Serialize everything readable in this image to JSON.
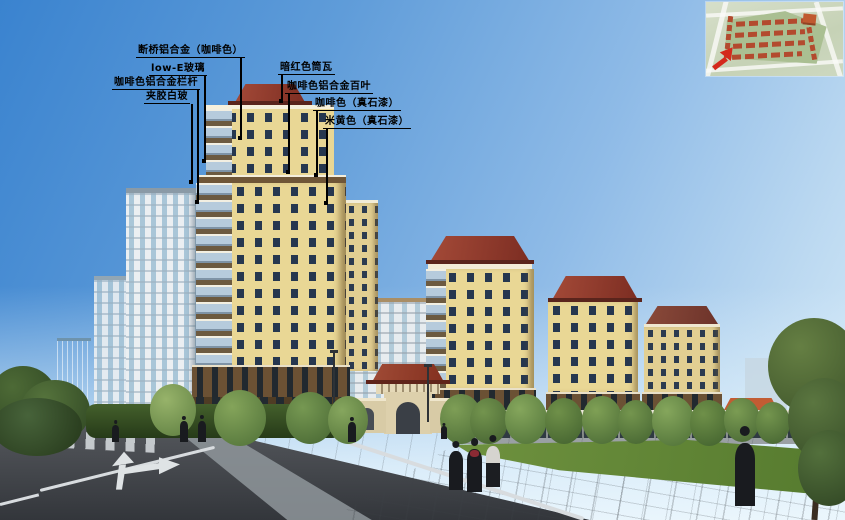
{
  "annotations": [
    {
      "id": "thermal-break-aluminum",
      "text": "断桥铝合金（咖啡色）"
    },
    {
      "id": "low-e-glass",
      "text": "low-E玻璃"
    },
    {
      "id": "coffee-aluminum-railing",
      "text": "咖啡色铝合金栏杆"
    },
    {
      "id": "laminated-white-glass",
      "text": "夹胶白玻"
    },
    {
      "id": "dark-red-barrel-tile",
      "text": "暗红色筒瓦"
    },
    {
      "id": "coffee-aluminum-louver",
      "text": "咖啡色铝合金百叶"
    },
    {
      "id": "coffee-stone-paint",
      "text": "咖啡色（真石漆）"
    },
    {
      "id": "beige-stone-paint",
      "text": "米黄色（真石漆）"
    }
  ],
  "icons": {
    "site_plan_arrow": "red-location-arrow"
  },
  "colors": {
    "sky_top": "#3a83cf",
    "sky_horizon": "#d6ebf9",
    "annotation_text": "#000000",
    "building_beige": "#e9d795",
    "building_window": "#26374f",
    "roof_dark_red": "#8b3a2c",
    "balcony_glass": "#b6cbdc",
    "white_tower": "#ebeff2",
    "road_asphalt": "#3a3e43",
    "road_marking": "#dde1e3",
    "lawn_green": "#64883c",
    "tree_green": "#48633a",
    "site_plan_arrow_red": "#d4291c"
  }
}
